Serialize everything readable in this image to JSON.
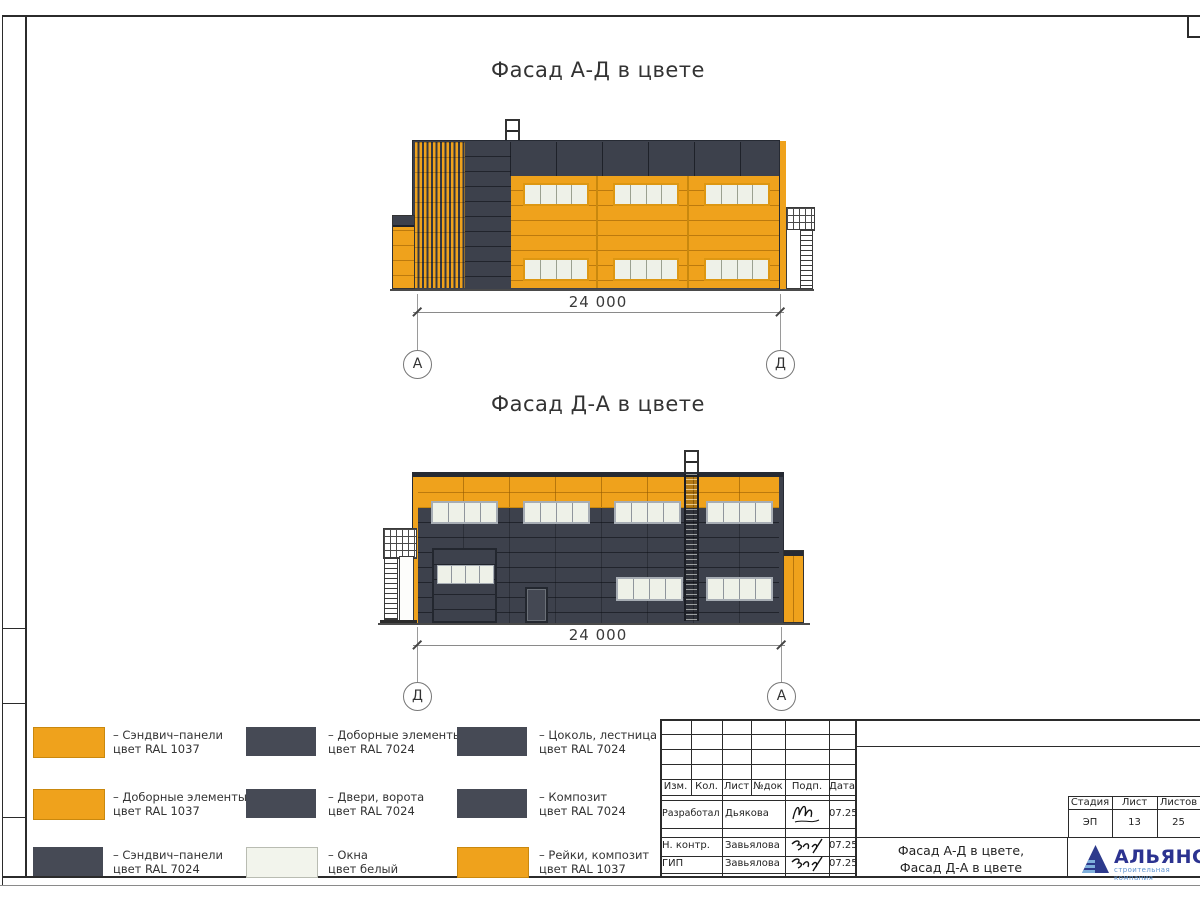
{
  "colors": {
    "orange_ral_1037": "#efa21c",
    "dark_ral_7024": "#3d414c",
    "window_white": "#eef1e8",
    "logo_blue": "#2c3390",
    "logo_light_blue": "#5e93cf"
  },
  "facade_top": {
    "title": "Фасад А-Д в цвете",
    "dimension": "24 000",
    "axis_left": "А",
    "axis_right": "Д"
  },
  "facade_bottom": {
    "title": "Фасад Д-А в цвете",
    "dimension": "24 000",
    "axis_left": "Д",
    "axis_right": "А"
  },
  "legend": {
    "items": [
      {
        "swatch": "orange",
        "color": "#efa21c",
        "line1": "– Сэндвич–панели",
        "line2": "цвет RAL 1037"
      },
      {
        "swatch": "orange",
        "color": "#efa21c",
        "line1": "– Доборные элементы",
        "line2": "цвет RAL 1037"
      },
      {
        "swatch": "dark",
        "color": "#464a55",
        "line1": "– Сэндвич–панели",
        "line2": "цвет RAL 7024"
      },
      {
        "swatch": "dark",
        "color": "#464a55",
        "line1": "– Доборные элементы",
        "line2": "цвет RAL 7024"
      },
      {
        "swatch": "dark",
        "color": "#464a55",
        "line1": "– Двери, ворота",
        "line2": "цвет RAL 7024"
      },
      {
        "swatch": "white",
        "color": "#f2f4ec",
        "line1": "– Окна",
        "line2": "цвет белый"
      },
      {
        "swatch": "dark",
        "color": "#464a55",
        "line1": "– Цоколь, лестница",
        "line2": "цвет RAL 7024"
      },
      {
        "swatch": "dark",
        "color": "#464a55",
        "line1": "– Композит",
        "line2": "цвет RAL 7024"
      },
      {
        "swatch": "orange",
        "color": "#efa21c",
        "line1": "– Рейки, композит",
        "line2": "цвет RAL 1037"
      }
    ]
  },
  "title_block": {
    "columns": [
      "Изм.",
      "Кол.",
      "Лист",
      "№док",
      "Подп.",
      "Дата"
    ],
    "rows": [
      {
        "role": "Разработал",
        "name": "Дьякова",
        "date": "07.25"
      },
      {
        "role": "Н. контр.",
        "name": "Завьялова",
        "date": "07.25"
      },
      {
        "role": "ГИП",
        "name": "Завьялова",
        "date": "07.25"
      }
    ],
    "stage_label": "Стадия",
    "stage_value": "ЭП",
    "sheet_label": "Лист",
    "sheet_value": "13",
    "sheets_label": "Листов",
    "sheets_value": "25",
    "doc_title_line1": "Фасад А-Д в цвете,",
    "doc_title_line2": "Фасад Д-А в цвете",
    "logo_name": "АЛЬЯНС",
    "logo_subtitle": "строительная компания"
  }
}
